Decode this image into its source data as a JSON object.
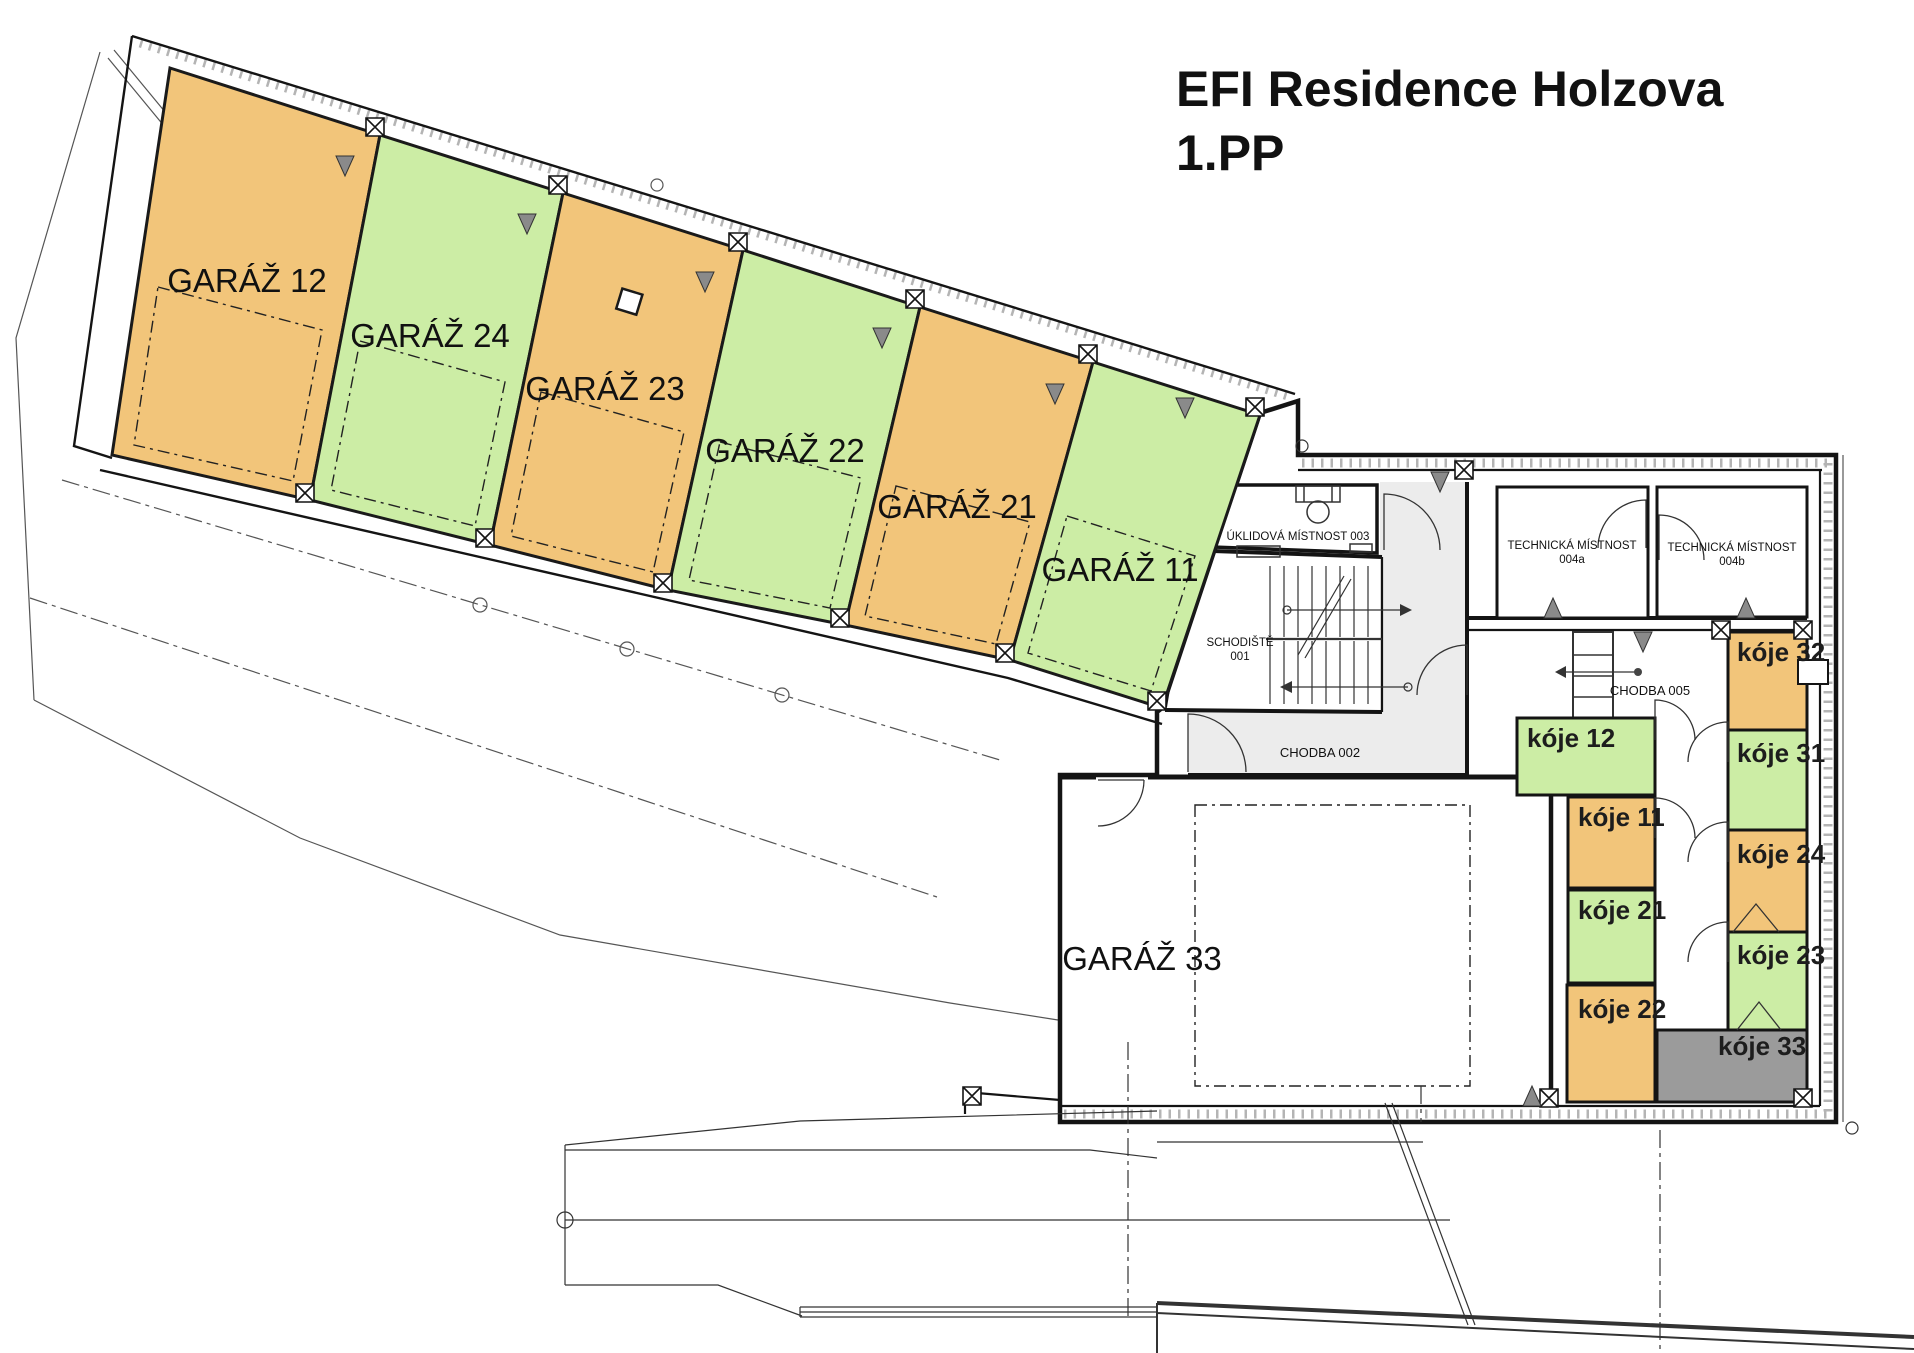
{
  "title": {
    "line1": "EFI Residence Holzova",
    "line2": "1.PP"
  },
  "colors": {
    "orange": "#F2C57A",
    "green": "#CCEDA5",
    "gray": "#9B9B9B",
    "corridor": "#ECECEC",
    "wall": "#141414",
    "white": "#FFFFFF"
  },
  "garages": [
    {
      "label": "GARÁŽ 12",
      "fill": "orange"
    },
    {
      "label": "GARÁŽ 24",
      "fill": "green"
    },
    {
      "label": "GARÁŽ 23",
      "fill": "orange"
    },
    {
      "label": "GARÁŽ 22",
      "fill": "green"
    },
    {
      "label": "GARÁŽ 21",
      "fill": "orange"
    },
    {
      "label": "GARÁŽ 11",
      "fill": "green"
    }
  ],
  "big_garage": {
    "label": "GARÁŽ  33"
  },
  "rooms": {
    "uklidova": "ÚKLIDOVÁ MÍSTNOST 003",
    "technicka": "TECHNICKÁ MÍSTNOST",
    "technicka_a": "004a",
    "technicka_b": "004b",
    "schodiste": "SCHODIŠTĚ",
    "schodiste_num": "001",
    "chodba_002": "CHODBA 002",
    "chodba_005": "CHODBA 005"
  },
  "koje": [
    {
      "label": "kóje 12",
      "fill": "green"
    },
    {
      "label": "kóje 11",
      "fill": "orange"
    },
    {
      "label": "kóje 21",
      "fill": "green"
    },
    {
      "label": "kóje 22",
      "fill": "orange"
    },
    {
      "label": "kóje 32",
      "fill": "orange"
    },
    {
      "label": "kóje 31",
      "fill": "green"
    },
    {
      "label": "kóje 24",
      "fill": "orange"
    },
    {
      "label": "kóje 23",
      "fill": "green"
    },
    {
      "label": "kóje 33",
      "fill": "gray"
    }
  ]
}
